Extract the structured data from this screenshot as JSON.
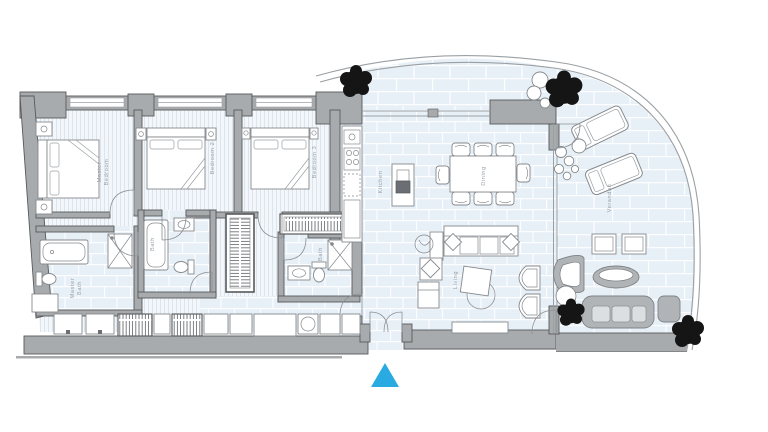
{
  "floor_plan": {
    "type": "apartment-floor-plan",
    "rooms": {
      "master_bedroom": {
        "label": "Master Bedroom",
        "line1": "Master",
        "line2": "Bedroom"
      },
      "bedroom_2": {
        "label": "Bedroom 2"
      },
      "bedroom_3": {
        "label": "Bedroom 3"
      },
      "master_bath": {
        "label": "Master Bath",
        "line1": "Master",
        "line2": "Bath"
      },
      "bath_2": {
        "label": "Bath"
      },
      "bath_3": {
        "label": "Bath"
      },
      "kitchen": {
        "label": "Kitchen"
      },
      "dining": {
        "label": "Dining"
      },
      "living": {
        "label": "Living"
      },
      "verandah": {
        "label": "Verandah"
      }
    },
    "entrance_marker": {
      "shape": "triangle-up",
      "color": "#29abe2"
    },
    "colors": {
      "background": "#ffffff",
      "wall": "#a8abad",
      "wall_outline": "#57595b",
      "tile_floor": "#e8f0f7",
      "tile_grout": "#fcfdff",
      "plank_floor": "#f3f7fb",
      "plank_line": "#d9e3ec",
      "furniture_outline": "#85898d",
      "label_text": "#98a0a8",
      "tree": "#151515",
      "outdoor_furniture": "#b0b4b6"
    },
    "furniture_icons": [
      "double-bed",
      "nightstand",
      "bathtub",
      "shower",
      "toilet",
      "sink",
      "vanity-basin",
      "wardrobe-hangers",
      "closet",
      "washer-dryer",
      "kitchen-counter",
      "cooktop",
      "kitchen-sink",
      "kitchen-island",
      "dining-table",
      "dining-chair",
      "sofa",
      "cushion",
      "console-table",
      "armchair",
      "chaise",
      "coffee-table",
      "barrel-chair",
      "tv-console",
      "indoor-plant",
      "sun-lounger",
      "side-table",
      "outdoor-armchair",
      "outdoor-coffee-table",
      "outdoor-sofa",
      "ottoman",
      "tree",
      "bush",
      "stones"
    ]
  }
}
